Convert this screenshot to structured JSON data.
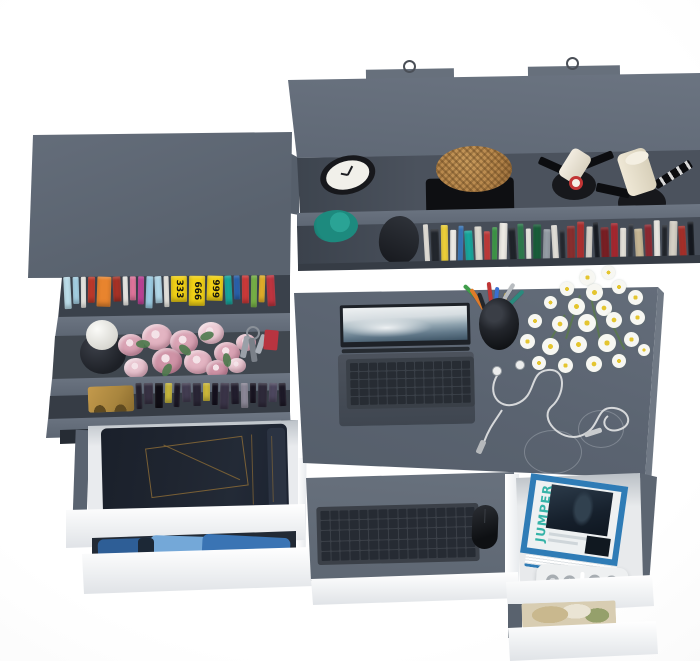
{
  "scene": {
    "description": "Top-down 3D product render of a graphite grey home office set: wall shelf with clock, basket and two lamps, bookcase with colourful books and roses, desk with laptop, pen cup, daisies and earphones, pull-out keyboard tray, and open white drawers holding jeans, blue clothes and magazines",
    "background": "#fbfbfb"
  },
  "palette": {
    "furniture": "#5f6875",
    "furniture_light": "#6d7683",
    "furniture_dark": "#474e59",
    "furniture_deep": "#3a414b",
    "drawer_front": "#f6f7f8",
    "interior_white": "#eaecee",
    "shadow": "#31373f"
  },
  "hutch": {
    "clock": {
      "ring": "#17181c",
      "face": "#f1f0ea"
    },
    "basket": {
      "body": "#b5854a",
      "base": "#0e0f12"
    },
    "lamp": {
      "shade": "#eae3d1",
      "base": "#17181c",
      "accent": "#c23535"
    },
    "cloth": "#1d8a7e",
    "cone": "#26292f",
    "books": [
      "#ece9e2",
      "#23272e",
      "#f2d43a",
      "#f6f4ef",
      "#3a7bc0",
      "#18a89e",
      "#e2ded4",
      "#c43a3a",
      "#3f9d4a",
      "#f0ede6",
      "#20242b",
      "#2e7d4f",
      "#f4f2ec",
      "#1a5e3a",
      "#98a0a8",
      "#eae7e0",
      "#262a31",
      "#8a2f2f",
      "#b03030",
      "#ddd8cf",
      "#191d24",
      "#7a1f24",
      "#a82830",
      "#ece8e0",
      "#31363e",
      "#c8b896",
      "#8f2a33",
      "#f1efe9",
      "#23272e",
      "#d8d3c8",
      "#a8302a",
      "#151920"
    ]
  },
  "bookshelf": {
    "top_books": [
      {
        "c": "#bfe2ef",
        "w": 7
      },
      {
        "c": "#a9d6ea",
        "w": 6
      },
      {
        "c": "#f2f0eb",
        "w": 5
      },
      {
        "c": "#c0392b",
        "w": 7
      },
      {
        "c": "#e8842e",
        "w": 14
      },
      {
        "c": "#a93226",
        "w": 8
      },
      {
        "c": "#f5f3ee",
        "w": 5
      },
      {
        "c": "#e878a0",
        "w": 6
      },
      {
        "c": "#c2439a",
        "w": 6
      },
      {
        "c": "#9fd0e8",
        "w": 7
      },
      {
        "c": "#b5dcee",
        "w": 7
      },
      {
        "c": "#f0eee8",
        "w": 5
      },
      {
        "c": "#f0d016",
        "w": 16,
        "label": "333"
      },
      {
        "c": "#f0d016",
        "w": 16,
        "label": "666"
      },
      {
        "c": "#f0d016",
        "w": 16,
        "label": "999"
      },
      {
        "c": "#18a89e",
        "w": 7
      },
      {
        "c": "#2a64b0",
        "w": 6
      },
      {
        "c": "#d03a3a",
        "w": 7
      },
      {
        "c": "#7ab648",
        "w": 6
      },
      {
        "c": "#e8b32a",
        "w": 6
      },
      {
        "c": "#c03540",
        "w": 8
      }
    ],
    "dark_books": [
      "#262230",
      "#383244",
      "#100e16",
      "#c8b83e",
      "#1c1826",
      "#433d52",
      "#2a2636",
      "#d0bc3a",
      "#15111e",
      "#3a3448",
      "#221e2e",
      "#8e8a9a",
      "#191522",
      "#2e2a3a",
      "#4e4860",
      "#1e1a28"
    ],
    "roses": [
      "#d9a3b4",
      "#e3b4c2",
      "#cf93a6",
      "#eccbd4",
      "#e8c4cf"
    ],
    "leaf": "#4d7a4d",
    "vase": "#26292f",
    "ball": "#e9e8e3",
    "bookend": "#a8853e",
    "red_box": "#b83440"
  },
  "desk": {
    "laptop": {
      "body": "#474d57",
      "deck": "#3a4048",
      "key": "#272c33",
      "screen_frame": "#1d2127"
    },
    "pens": [
      "#3f9d4a",
      "#e07b2a",
      "#23262b",
      "#c03535",
      "#3a6fd0",
      "#e8c23a",
      "#b8bcc0",
      "#2a8a7d"
    ],
    "cup": "#1c1f24",
    "daisy_petal": "#f7f7f2",
    "daisy_center": "#e4c52f",
    "stem": "#5a7a4a",
    "cable": "#d6d8da"
  },
  "tray": {
    "surface": "#626b77",
    "keyboard_base": "#3b4048",
    "key": "#262b33",
    "mouse": "#15171b"
  },
  "left_drawers": {
    "jeans": "#1f2530",
    "jeans_light": "#2b3342",
    "stitch": "#8a6a36",
    "blues": [
      "#2e5e96",
      "#74a8d8",
      "#3a74b4"
    ]
  },
  "right_pedestal": {
    "magazine_title": "JUMPER",
    "magazine_frame": "#2f7cb6",
    "magazine_text": "#35b3a8",
    "photo": "#16202c",
    "strip": "#eef0f1",
    "socket": "#b9bec2"
  }
}
